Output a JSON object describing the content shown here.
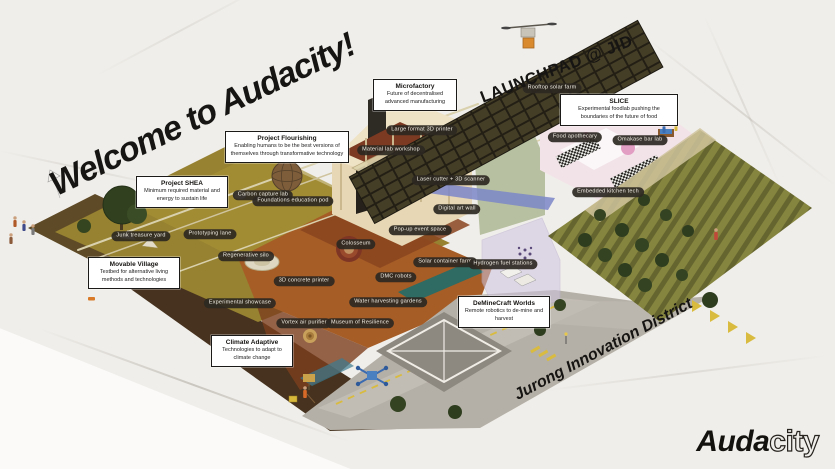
{
  "titles": {
    "welcome": "Welcome to Audacity!",
    "launchpad": "LAUNCHPAD @ JID",
    "district": "Jurong Innovation District"
  },
  "logo": {
    "solid": "Auda",
    "outline": "city"
  },
  "callouts": [
    {
      "title": "Microfactory",
      "description": "Future of decentralised advanced manufacturing"
    },
    {
      "title": "Project Flourishing",
      "description": "Enabling humans to be the best versions of themselves through transformative technology"
    },
    {
      "title": "Project SHEA",
      "description": "Minimum required material and energy to sustain life"
    },
    {
      "title": "Movable Village",
      "description": "Testbed for alternative living methods and technologies"
    },
    {
      "title": "Climate Adaptive",
      "description": "Technologies to adapt to climate change"
    },
    {
      "title": "DeMineCraft Worlds",
      "description": "Remote robotics to de-mine and harvest"
    },
    {
      "title": "SLICE",
      "description": "Experimental foodlab pushing the boundaries of the future of food"
    }
  ],
  "map_labels": [
    "Rooftop solar farm",
    "Large format 3D printer",
    "Material lab workshop",
    "Laser cutter + 3D scanner",
    "Digital art wall",
    "Pop-up event space",
    "Carbon capture lab",
    "Foundations education pod",
    "Junk treasure yard",
    "Prototyping lane",
    "Regenerative silo",
    "3D concrete printer",
    "Experimental showcase",
    "Colosseum",
    "Solar container farm",
    "Hydrogen fuel stations",
    "DMC robots",
    "Water harvesting gardens",
    "Vortex air purifier",
    "Museum of Resilience",
    "Food apothecary",
    "Omakase bar lab",
    "Embedded kitchen tech"
  ],
  "colors": {
    "paper": "#f0eeea",
    "ink": "#171513",
    "pill_bg": "#2c2822",
    "terrain_olive": "#968230",
    "terrain_orange": "#a65d26",
    "solar_dark": "#231f15",
    "field_green": "#85853f",
    "plaza_gray": "#b5b0a7",
    "accent_yellow": "#d8bb3f"
  }
}
